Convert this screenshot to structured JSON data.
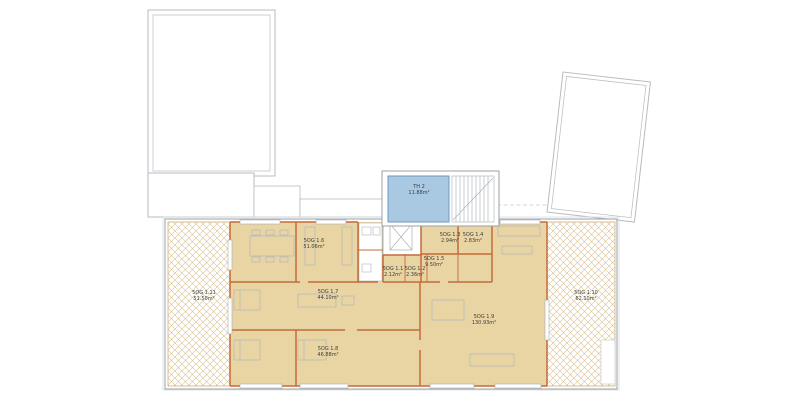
{
  "rooms": [
    {
      "name": "TH 2",
      "area": "11.88m²"
    },
    {
      "name": "5OG 1.1",
      "area": "2.12m²"
    },
    {
      "name": "5OG 1.2",
      "area": "2.36m²"
    },
    {
      "name": "5OG 1.3",
      "area": "2.94m²"
    },
    {
      "name": "5OG 1.4",
      "area": "2.83m²"
    },
    {
      "name": "5OG 1.5",
      "area": "9.50m²"
    },
    {
      "name": "5OG 1.6",
      "area": "51.06m²"
    },
    {
      "name": "5OG 1.7",
      "area": "44.10m²"
    },
    {
      "name": "5OG 1.8",
      "area": "46.88m²"
    },
    {
      "name": "5OG 1.9",
      "area": "130.93m²"
    },
    {
      "name": "5OG 1.10",
      "area": "62.10m²"
    },
    {
      "name": "5OG 1.11",
      "area": "51.50m²"
    }
  ],
  "colors": {
    "apartment_fill": "#e9d5a4",
    "interior_wall": "#c26b38",
    "stairwell_fill": "#a9c9e2",
    "stairwell_border": "#7096b8",
    "terrace_hatch": "#d9c193",
    "exterior_outline": "#9aa0a6"
  }
}
